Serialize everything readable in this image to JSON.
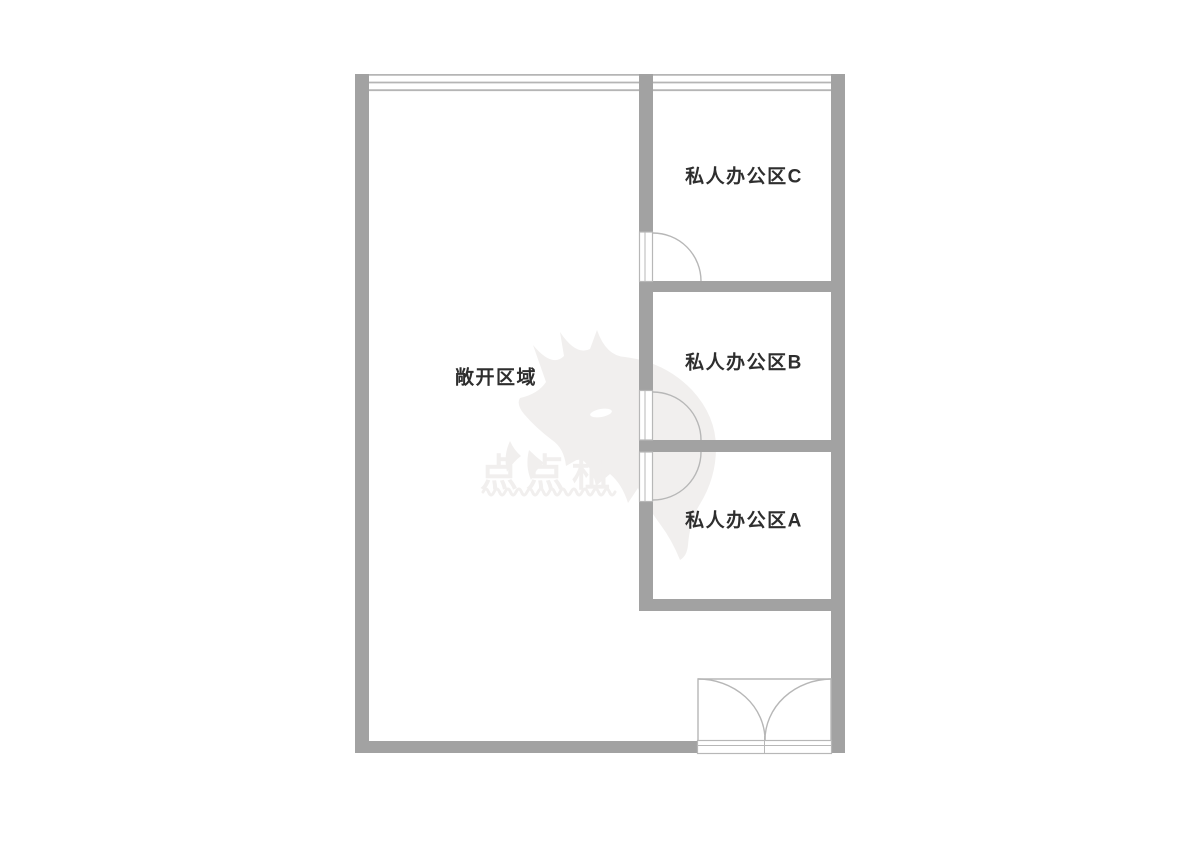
{
  "floorplan": {
    "open_area": {
      "label": "敞开区域"
    },
    "rooms": [
      {
        "id": "private-office-c",
        "label": "私人办公区C"
      },
      {
        "id": "private-office-b",
        "label": "私人办公区B"
      },
      {
        "id": "private-office-a",
        "label": "私人办公区A"
      }
    ],
    "watermark": {
      "text": "点点租",
      "logo": "fox-logo-icon"
    },
    "features": {
      "windows": [
        "top-exterior-window"
      ],
      "doors": [
        "office-c-swing-door",
        "office-b-swing-door",
        "office-a-swing-door",
        "main-entrance-double-door"
      ]
    }
  },
  "colors": {
    "wall": "#a2a2a2",
    "door_line": "#b7b7b7",
    "window_line": "#b5b5b5",
    "label_text": "#2e2e2e",
    "watermark": "#f1efee"
  }
}
